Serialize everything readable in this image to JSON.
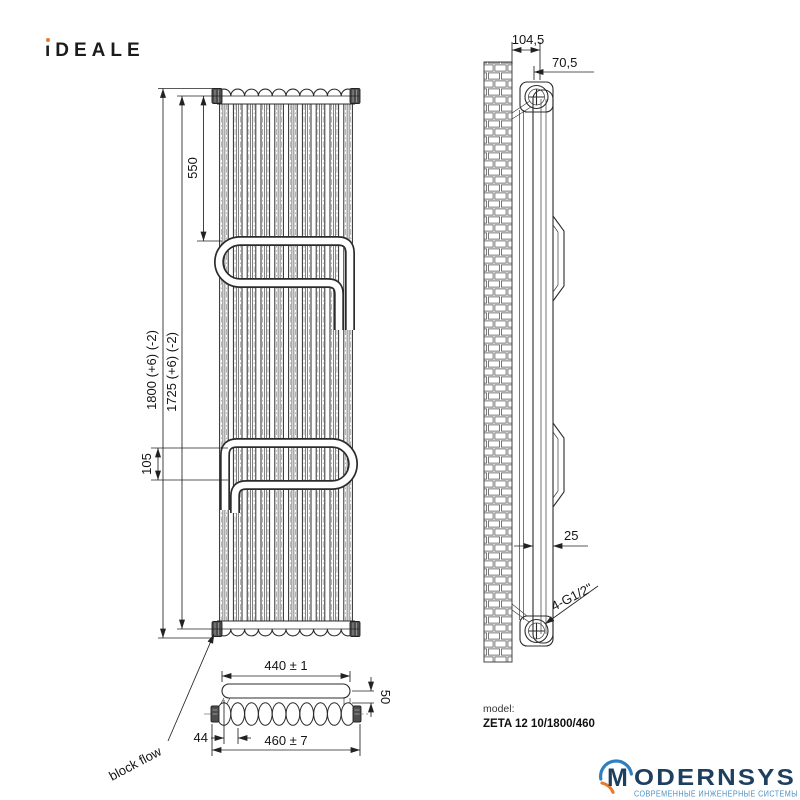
{
  "brand": {
    "ideale_stem": "ı",
    "ideale_rest": "DEALE",
    "dot_color": "#e87a2e"
  },
  "front_view": {
    "dims": {
      "top_to_bar": "550",
      "overall_height": "1800 (+6) (-2)",
      "pipe_centers": "1725 (+6) (-2)",
      "bar_gap": "105"
    },
    "block_flow_label": "block flow"
  },
  "bottom_view": {
    "dims": {
      "bar_width": "440 ± 1",
      "bar_offset": "50",
      "section_pitch": "44",
      "overall_width": "460 ± 7"
    }
  },
  "side_view": {
    "dims": {
      "wall_to_front": "104,5",
      "wall_to_axis": "70,5",
      "tube_depth": "25",
      "connections": "4-G1/2\""
    }
  },
  "model": {
    "label": "model:",
    "value": "ZETA 12 10/1800/460"
  },
  "footer_logo": {
    "m": "M",
    "rest": "ODERNSYS",
    "tagline": "СОВРЕМЕННЫЕ ИНЖЕНЕРНЫЕ СИСТЕМЫ",
    "navy": "#1d3f60",
    "blue": "#2e7fc2",
    "orange": "#e87a2e",
    "tagline_color": "#4a90c4"
  },
  "colors": {
    "ink": "#2b2b2b",
    "accent_orange": "#e87a2e"
  }
}
